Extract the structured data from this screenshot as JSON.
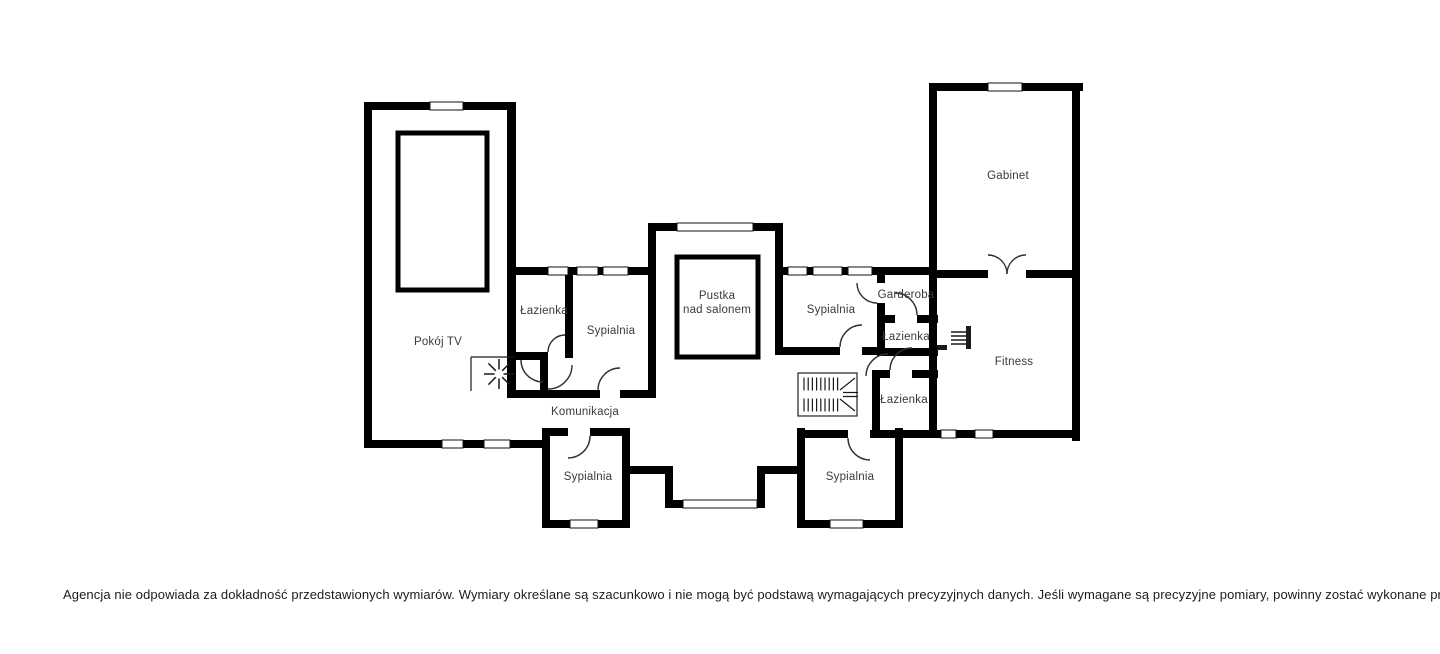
{
  "plan": {
    "colors": {
      "wall": "#000000",
      "label": "#3a3a3a",
      "door_arc": "#2e2e2e",
      "background": "#ffffff"
    },
    "rooms": {
      "pokoj_tv": "Pokój TV",
      "lazienka_left": "Łazienka",
      "sypialnia_left": "Sypialnia",
      "pustka_line1": "Pustka",
      "pustka_line2": "nad salonem",
      "komunikacja": "Komunikacja",
      "sypialnia_center": "Sypialnia",
      "garderoba": "Garderoba",
      "lazienka_top_right": "Łazienka",
      "lazienka_bottom_right": "Łazienka",
      "gabinet": "Gabinet",
      "fitness": "Fitness",
      "sypialnia_bottom_left": "Sypialnia",
      "sypialnia_bottom_right": "Sypialnia"
    },
    "symbols": [
      "stairs",
      "fireplace",
      "radiator",
      "windows",
      "door-swings"
    ]
  },
  "footer": {
    "disclaimer": "Agencja nie odpowiada za dokładność przedstawionych wymiarów. Wymiary określane są szacunkowo i nie mogą być podstawą wymagających precyzyjnych danych. Jeśli wymagane są precyzyjne pomiary, powinny zostać wykonane przez profesjonalistę."
  }
}
